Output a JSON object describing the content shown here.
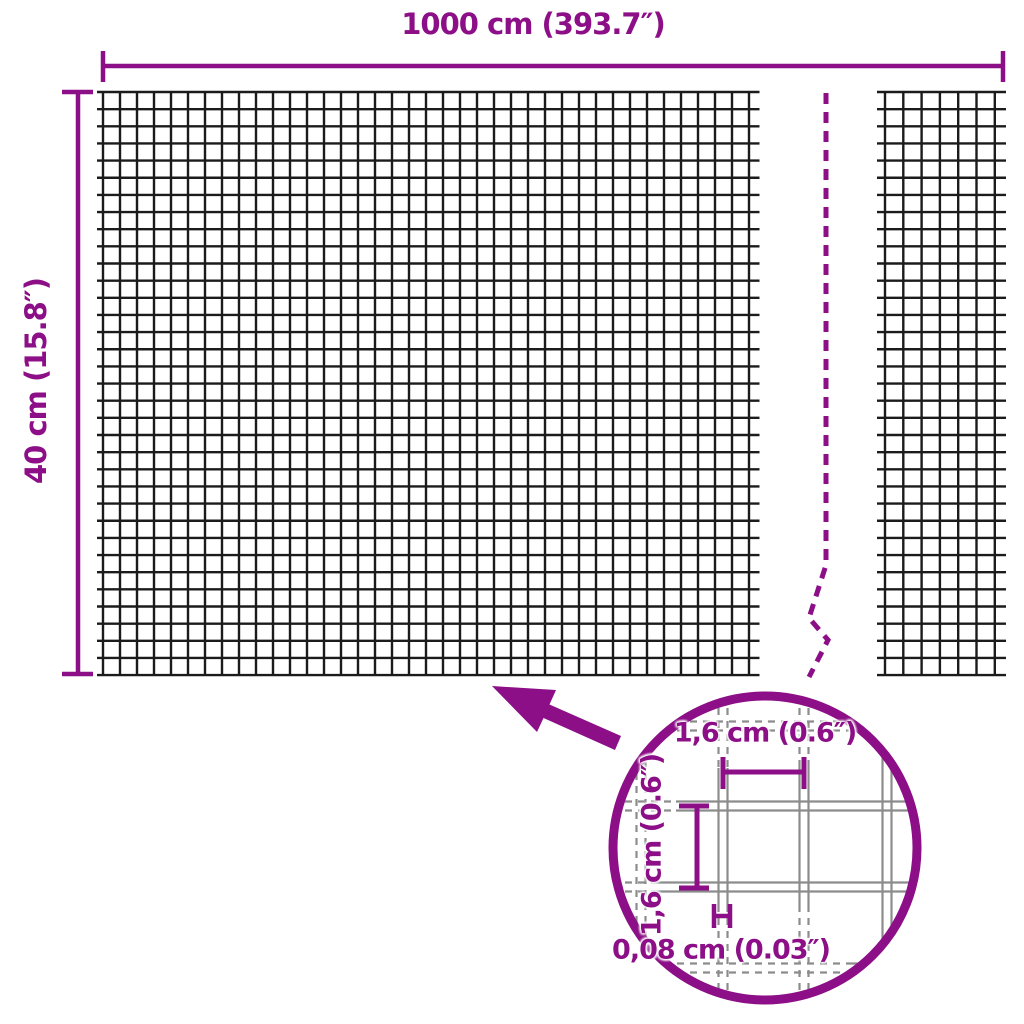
{
  "colors": {
    "accent": "#8C0F87",
    "mesh_line": "#1b1b1b",
    "wire_outline": "#8c8c8c",
    "background": "#ffffff"
  },
  "overall_dimensions": {
    "width_label": "1000 cm (393.7″)",
    "height_label": "40 cm (15.8″)"
  },
  "detail_view": {
    "mesh_opening_width_label": "1,6 cm (0.6″)",
    "mesh_opening_height_label": "1,6 cm (0.6″)",
    "wire_thickness_label": "0,08 cm (0.03″)"
  }
}
